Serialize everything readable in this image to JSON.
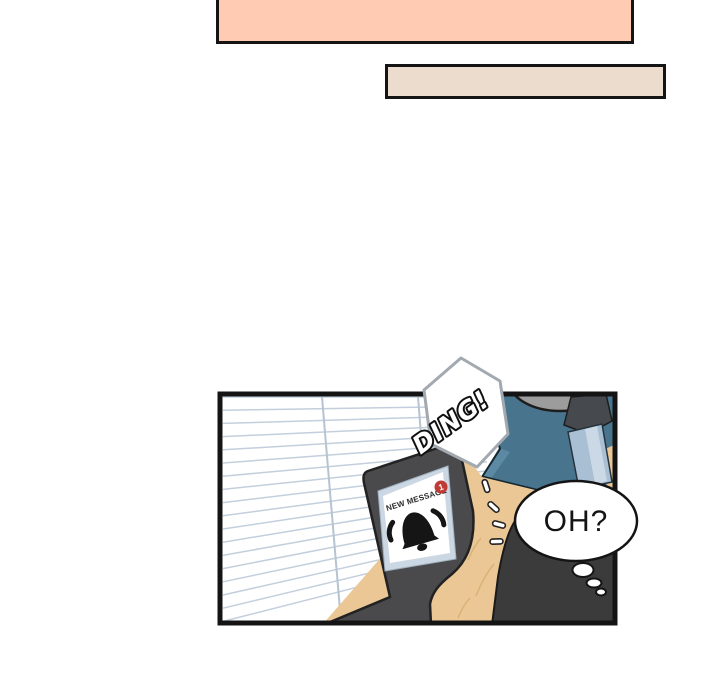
{
  "page": {
    "background": "#ffffff"
  },
  "caption_boxes": [
    {
      "name": "top narration box (cut off at top edge)",
      "fill": "#FFCBB2",
      "border": "#141414"
    },
    {
      "name": "second narration box",
      "fill": "#ECDCCE",
      "border": "#141414"
    }
  ],
  "panel": {
    "border_color": "#141414",
    "sfx": {
      "ding": "DING!"
    },
    "thought_bubble": {
      "text": "OH?"
    },
    "phone": {
      "notification_label": "NEW MESSAGE",
      "badge_count": "1"
    },
    "colors": {
      "blinds_line": "#C3CFDC",
      "chair_teal": "#48748E",
      "chair_edge": "#17272F",
      "seat_gray": "#9C9C9C",
      "pen_body": "#A9BFD3",
      "pen_highlight": "#CBD9E6",
      "pen_cap": "#46494D",
      "wood": "#EAC795",
      "wood_grain": "#D9B277",
      "silhouette": "#3B3B3B",
      "phone_body": "#4A4A4C",
      "screen_frame": "#CBD7E2",
      "badge_red": "#C03A35",
      "hexagon_border": "#A3A9B0"
    }
  }
}
